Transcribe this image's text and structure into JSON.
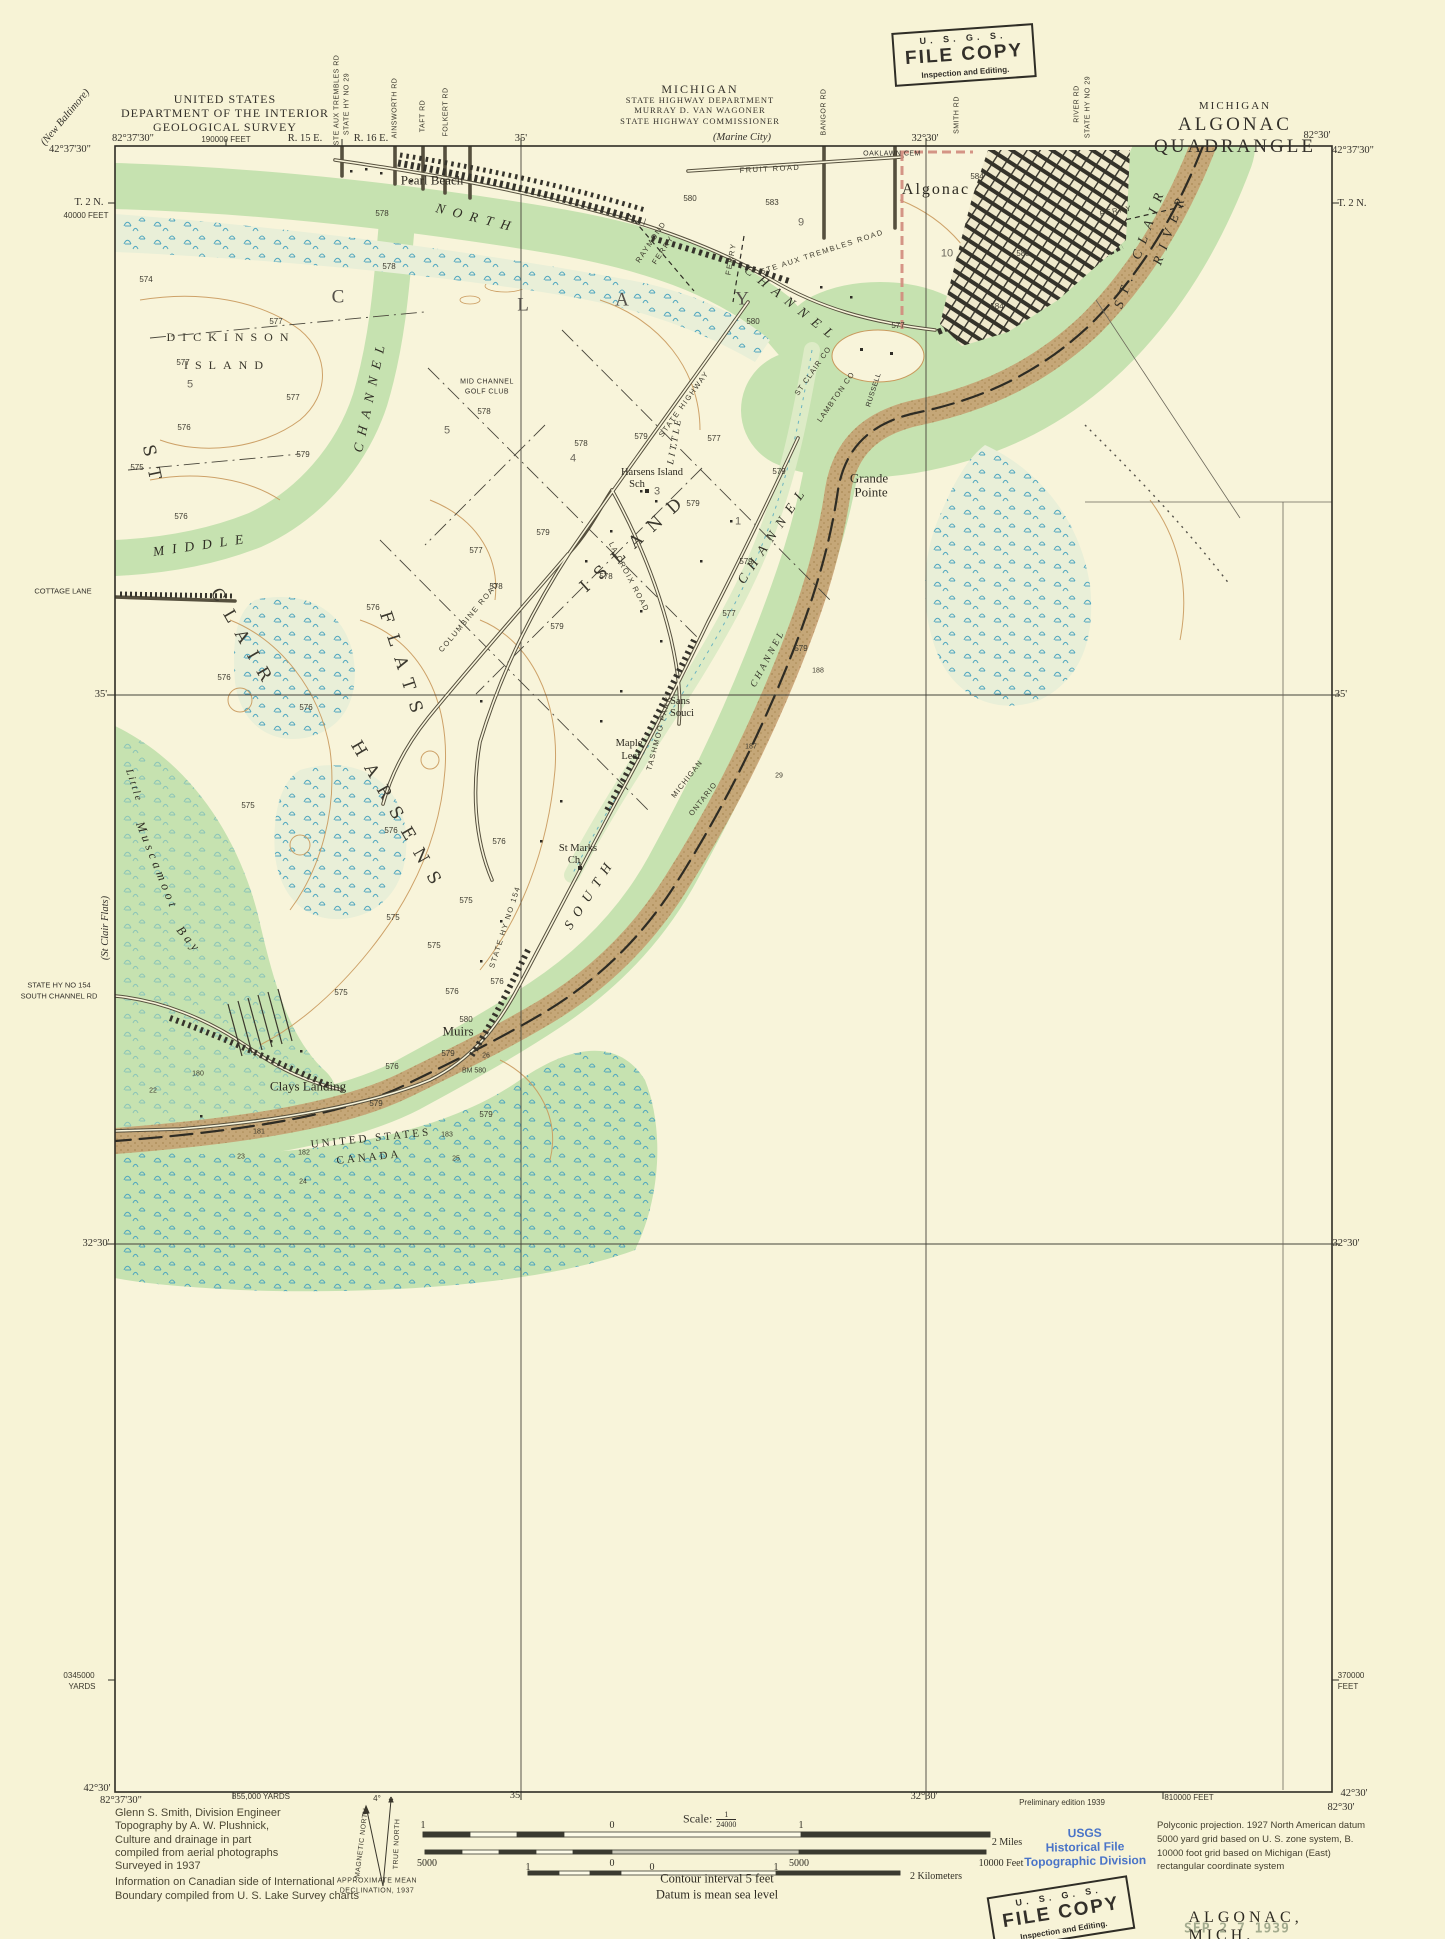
{
  "colors": {
    "paper": "#f7f3d6",
    "land": "#f8f4da",
    "water": "#c6e2b0",
    "marsh_base": "#e9efd8",
    "marsh_symbol": "#4fa6bf",
    "contour": "#c9995c",
    "urban": "#35332a",
    "channel_band": "#c59d6e",
    "boundary": "#2e2c24",
    "city_limit_pink": "#d18a7c",
    "stamp_blue": "#4a74c8",
    "date_stamp_green": "#a3ab8e"
  },
  "header": {
    "agency": [
      "UNITED STATES",
      "DEPARTMENT OF THE INTERIOR",
      "GEOLOGICAL SURVEY"
    ],
    "highway": [
      "MICHIGAN",
      "STATE HIGHWAY DEPARTMENT",
      "MURRAY D. VAN WAGONER",
      "STATE HIGHWAY COMMISSIONER"
    ],
    "quad_state": "MICHIGAN",
    "quad_name": "ALGONAC QUADRANGLE"
  },
  "stamps": {
    "top": {
      "line1": "U. S. G. S.",
      "line2": "FILE COPY",
      "line3": "Inspection and Editing."
    },
    "bottom": {
      "line1": "U. S. G. S.",
      "line2": "FILE COPY",
      "line3": "Inspection and Editing."
    },
    "blue": [
      "USGS",
      "Historical File",
      "Topographic Division"
    ],
    "date": "SEP 2 7 1939"
  },
  "footer": {
    "credits": [
      "Glenn S. Smith, Division Engineer",
      "Topography by A. W. Plushnick,",
      "Culture and drainage in part",
      "compiled from aerial photographs",
      "Surveyed in 1937",
      "Information on Canadian side of International",
      "Boundary compiled from U. S. Lake Survey charts"
    ],
    "scale_prefix": "Scale:",
    "scale_num": "1",
    "scale_den": "24000",
    "contour": "Contour interval 5 feet",
    "datum": "Datum is mean sea level",
    "projection": [
      "Polyconic projection.   1927 North American datum",
      "5000 yard grid based on U. S. zone system, B.",
      "10000 foot grid based on Michigan (East)",
      "rectangular coordinate system"
    ],
    "map_name": "ALGONAC, MICH."
  },
  "map_labels": [
    {
      "t": "Pearl Beach",
      "x": 432,
      "y": 180,
      "c": "place"
    },
    {
      "t": "Algonac",
      "x": 936,
      "y": 190,
      "c": "place-lg"
    },
    {
      "t": "NORTH",
      "x": 477,
      "y": 218,
      "r": 14,
      "c": "hydro"
    },
    {
      "t": "CHANNEL",
      "x": 792,
      "y": 304,
      "r": 38,
      "c": "hydro"
    },
    {
      "t": "ST",
      "x": 152,
      "y": 468,
      "r": 78,
      "c": "hydro-lg"
    },
    {
      "t": "CLAIR",
      "x": 243,
      "y": 640,
      "r": 60,
      "c": "hydro-lg"
    },
    {
      "t": "FLATS",
      "x": 402,
      "y": 668,
      "r": 72,
      "c": "hydro-lg"
    },
    {
      "t": "HARSENS",
      "x": 398,
      "y": 818,
      "r": 60,
      "c": "hydro-lg"
    },
    {
      "t": "ISLAND",
      "x": 636,
      "y": 542,
      "r": -42,
      "c": "hydro-lg"
    },
    {
      "t": "MIDDLE",
      "x": 202,
      "y": 545,
      "r": -8,
      "c": "hydro"
    },
    {
      "t": "CHANNEL",
      "x": 370,
      "y": 395,
      "r": -78,
      "c": "hydro"
    },
    {
      "t": "SOUTH",
      "x": 590,
      "y": 893,
      "r": -57,
      "c": "hydro"
    },
    {
      "t": "CHANNEL",
      "x": 773,
      "y": 534,
      "r": -56,
      "c": "hydro"
    },
    {
      "t": "LITTLE",
      "x": 676,
      "y": 441,
      "r": -80,
      "c": "hydro-sm"
    },
    {
      "t": "CHANNEL",
      "x": 769,
      "y": 659,
      "r": -62,
      "c": "hydro-sm"
    },
    {
      "t": "ST. CLAIR",
      "x": 1140,
      "y": 247,
      "r": -70,
      "c": "hydro"
    },
    {
      "t": "RIVER",
      "x": 1170,
      "y": 228,
      "r": -70,
      "c": "hydro"
    },
    {
      "t": "DICKINSON",
      "x": 231,
      "y": 337,
      "c": "area"
    },
    {
      "t": "ISLAND",
      "x": 227,
      "y": 365,
      "c": "area"
    },
    {
      "t": "C",
      "x": 338,
      "y": 297,
      "c": "area-lg"
    },
    {
      "t": "L",
      "x": 523,
      "y": 305,
      "c": "area-lg"
    },
    {
      "t": "A",
      "x": 622,
      "y": 300,
      "c": "area-lg"
    },
    {
      "t": "Y",
      "x": 742,
      "y": 299,
      "c": "area-lg"
    },
    {
      "t": "Little",
      "x": 133,
      "y": 786,
      "r": 72,
      "c": "bay-sm"
    },
    {
      "t": "Muscamoot",
      "x": 157,
      "y": 866,
      "r": 68,
      "c": "bay"
    },
    {
      "t": "Bay",
      "x": 189,
      "y": 940,
      "r": 50,
      "c": "bay"
    },
    {
      "t": "Grande",
      "x": 869,
      "y": 478,
      "c": "place"
    },
    {
      "t": "Pointe",
      "x": 871,
      "y": 492,
      "c": "place"
    },
    {
      "t": "Sans",
      "x": 680,
      "y": 702,
      "c": "place-sm"
    },
    {
      "t": "Souci",
      "x": 682,
      "y": 714,
      "c": "place-sm"
    },
    {
      "t": "Maple",
      "x": 629,
      "y": 744,
      "c": "place-sm"
    },
    {
      "t": "Leaf",
      "x": 631,
      "y": 757,
      "c": "place-sm"
    },
    {
      "t": "St Marks",
      "x": 578,
      "y": 849,
      "c": "place-sm"
    },
    {
      "t": "Ch",
      "x": 574,
      "y": 861,
      "c": "place-sm"
    },
    {
      "t": "Muirs",
      "x": 458,
      "y": 1031,
      "c": "place"
    },
    {
      "t": "Clays Landing",
      "x": 308,
      "y": 1086,
      "c": "place"
    },
    {
      "t": "Harsens Island",
      "x": 652,
      "y": 473,
      "c": "place-sm"
    },
    {
      "t": "Sch",
      "x": 637,
      "y": 485,
      "c": "place-sm"
    },
    {
      "t": "MID CHANNEL",
      "x": 487,
      "y": 382,
      "c": "tiny"
    },
    {
      "t": "GOLF CLUB",
      "x": 487,
      "y": 392,
      "c": "tiny"
    },
    {
      "t": "RUSSELL",
      "x": 874,
      "y": 390,
      "r": -72,
      "c": "tiny"
    },
    {
      "t": "OAKLAWN CEM",
      "x": 892,
      "y": 154,
      "c": "tiny"
    },
    {
      "t": "FRUIT ROAD",
      "x": 770,
      "y": 169,
      "r": -3,
      "c": "road"
    },
    {
      "t": "STE AUX TREMBLES ROAD",
      "x": 822,
      "y": 252,
      "r": -18,
      "c": "road"
    },
    {
      "t": "STATE HIGHWAY",
      "x": 684,
      "y": 404,
      "r": -54,
      "c": "road"
    },
    {
      "t": "COLUMBINE ROAD",
      "x": 469,
      "y": 617,
      "r": -50,
      "c": "road"
    },
    {
      "t": "LA CROIX ROAD",
      "x": 629,
      "y": 577,
      "r": 62,
      "c": "road"
    },
    {
      "t": "TASHMOO PARK",
      "x": 659,
      "y": 733,
      "r": -75,
      "c": "road"
    },
    {
      "t": "STATE HY NO 154",
      "x": 505,
      "y": 927,
      "r": -72,
      "c": "road"
    },
    {
      "t": "RAYMOND",
      "x": 651,
      "y": 242,
      "r": -56,
      "c": "road"
    },
    {
      "t": "FERRY",
      "x": 663,
      "y": 250,
      "r": -56,
      "c": "road"
    },
    {
      "t": "FERRY",
      "x": 1116,
      "y": 211,
      "r": -10,
      "c": "road"
    },
    {
      "t": "FERRY",
      "x": 731,
      "y": 259,
      "r": -80,
      "c": "road"
    },
    {
      "t": "UNITED STATES",
      "x": 371,
      "y": 1139,
      "r": -6,
      "c": "bdy"
    },
    {
      "t": "CANADA",
      "x": 369,
      "y": 1158,
      "r": -6,
      "c": "bdy"
    },
    {
      "t": "MICHIGAN",
      "x": 687,
      "y": 779,
      "r": -52,
      "c": "bdy-sm"
    },
    {
      "t": "ONTARIO",
      "x": 703,
      "y": 799,
      "r": -52,
      "c": "bdy-sm"
    },
    {
      "t": "ST CLAIR CO",
      "x": 813,
      "y": 371,
      "r": -55,
      "c": "bdy-sm"
    },
    {
      "t": "LAMBTON CO",
      "x": 836,
      "y": 397,
      "r": -55,
      "c": "bdy-sm"
    }
  ],
  "numbers": [
    {
      "t": "574",
      "x": 146,
      "y": 280
    },
    {
      "t": "577",
      "x": 276,
      "y": 322
    },
    {
      "t": "577",
      "x": 183,
      "y": 363
    },
    {
      "t": "577",
      "x": 293,
      "y": 398
    },
    {
      "t": "576",
      "x": 184,
      "y": 428
    },
    {
      "t": "579",
      "x": 303,
      "y": 455
    },
    {
      "t": "575",
      "x": 137,
      "y": 468
    },
    {
      "t": "576",
      "x": 181,
      "y": 517
    },
    {
      "t": "578",
      "x": 382,
      "y": 214
    },
    {
      "t": "578",
      "x": 389,
      "y": 267
    },
    {
      "t": "576",
      "x": 373,
      "y": 608
    },
    {
      "t": "576",
      "x": 224,
      "y": 678
    },
    {
      "t": "576",
      "x": 306,
      "y": 708
    },
    {
      "t": "575",
      "x": 248,
      "y": 806
    },
    {
      "t": "576",
      "x": 391,
      "y": 831
    },
    {
      "t": "576",
      "x": 499,
      "y": 842
    },
    {
      "t": "575",
      "x": 466,
      "y": 901
    },
    {
      "t": "575",
      "x": 393,
      "y": 918
    },
    {
      "t": "575",
      "x": 434,
      "y": 946
    },
    {
      "t": "576",
      "x": 497,
      "y": 982
    },
    {
      "t": "576",
      "x": 452,
      "y": 992
    },
    {
      "t": "575",
      "x": 341,
      "y": 993
    },
    {
      "t": "576",
      "x": 392,
      "y": 1067
    },
    {
      "t": "580",
      "x": 466,
      "y": 1020
    },
    {
      "t": "579",
      "x": 448,
      "y": 1054
    },
    {
      "t": "579",
      "x": 486,
      "y": 1115
    },
    {
      "t": "579",
      "x": 376,
      "y": 1104
    },
    {
      "t": "578",
      "x": 581,
      "y": 444
    },
    {
      "t": "578",
      "x": 484,
      "y": 412
    },
    {
      "t": "579",
      "x": 641,
      "y": 437
    },
    {
      "t": "577",
      "x": 714,
      "y": 439
    },
    {
      "t": "579",
      "x": 779,
      "y": 472
    },
    {
      "t": "579",
      "x": 693,
      "y": 504
    },
    {
      "t": "577",
      "x": 476,
      "y": 551
    },
    {
      "t": "579",
      "x": 543,
      "y": 533
    },
    {
      "t": "578",
      "x": 496,
      "y": 587
    },
    {
      "t": "579",
      "x": 557,
      "y": 627
    },
    {
      "t": "577",
      "x": 729,
      "y": 614
    },
    {
      "t": "579",
      "x": 746,
      "y": 562
    },
    {
      "t": "579",
      "x": 801,
      "y": 649
    },
    {
      "t": "578",
      "x": 606,
      "y": 577
    },
    {
      "t": "583",
      "x": 772,
      "y": 203
    },
    {
      "t": "584",
      "x": 977,
      "y": 177
    },
    {
      "t": "580",
      "x": 1023,
      "y": 254
    },
    {
      "t": "584",
      "x": 997,
      "y": 307
    },
    {
      "t": "580",
      "x": 690,
      "y": 199
    },
    {
      "t": "577",
      "x": 898,
      "y": 326
    },
    {
      "t": "580",
      "x": 753,
      "y": 322
    },
    {
      "t": "9",
      "x": 801,
      "y": 223,
      "c": "section"
    },
    {
      "t": "10",
      "x": 947,
      "y": 254,
      "c": "section"
    },
    {
      "t": "5",
      "x": 190,
      "y": 385,
      "c": "section"
    },
    {
      "t": "5",
      "x": 447,
      "y": 431,
      "c": "section"
    },
    {
      "t": "4",
      "x": 573,
      "y": 459,
      "c": "section"
    },
    {
      "t": "3",
      "x": 657,
      "y": 492,
      "c": "section"
    },
    {
      "t": "1",
      "x": 738,
      "y": 522,
      "c": "section"
    },
    {
      "t": "188",
      "x": 818,
      "y": 671,
      "c": "mon"
    },
    {
      "t": "187",
      "x": 751,
      "y": 747,
      "c": "mon"
    },
    {
      "t": "183",
      "x": 447,
      "y": 1135,
      "c": "mon"
    },
    {
      "t": "182",
      "x": 304,
      "y": 1153,
      "c": "mon"
    },
    {
      "t": "181",
      "x": 259,
      "y": 1132,
      "c": "mon"
    },
    {
      "t": "180",
      "x": 198,
      "y": 1074,
      "c": "mon"
    },
    {
      "t": "29",
      "x": 779,
      "y": 776,
      "c": "mon"
    },
    {
      "t": "26",
      "x": 486,
      "y": 1056,
      "c": "mon"
    },
    {
      "t": "25",
      "x": 456,
      "y": 1159,
      "c": "mon"
    },
    {
      "t": "24",
      "x": 303,
      "y": 1182,
      "c": "mon"
    },
    {
      "t": "23",
      "x": 241,
      "y": 1157,
      "c": "mon"
    },
    {
      "t": "22",
      "x": 153,
      "y": 1091,
      "c": "mon"
    },
    {
      "t": "BM 580",
      "x": 474,
      "y": 1071,
      "c": "mon"
    }
  ],
  "annotations": [
    {
      "t": "82°37'30\"",
      "x": 133,
      "y": 139
    },
    {
      "t": "190000 FEET",
      "x": 226,
      "y": 140,
      "c": "coord-sm"
    },
    {
      "t": "R. 15 E.",
      "x": 305,
      "y": 139
    },
    {
      "t": "R. 16 E.",
      "x": 371,
      "y": 139
    },
    {
      "t": "35'",
      "x": 521,
      "y": 139
    },
    {
      "t": "(Marine City)",
      "x": 742,
      "y": 138,
      "c": "dest"
    },
    {
      "t": "32°30'",
      "x": 925,
      "y": 139
    },
    {
      "t": "82°30'",
      "x": 1317,
      "y": 136
    },
    {
      "t": "42°37'30\"",
      "x": 1353,
      "y": 151
    },
    {
      "t": "STE AUX TREMBLES RD",
      "x": 337,
      "y": 100,
      "r": -90,
      "c": "vroad"
    },
    {
      "t": "STATE HY NO 29",
      "x": 347,
      "y": 104,
      "r": -90,
      "c": "vroad"
    },
    {
      "t": "AINSWORTH RD",
      "x": 395,
      "y": 108,
      "r": -90,
      "c": "vroad"
    },
    {
      "t": "TAFT RD",
      "x": 423,
      "y": 116,
      "r": -90,
      "c": "vroad"
    },
    {
      "t": "FOLKERT RD",
      "x": 446,
      "y": 112,
      "r": -90,
      "c": "vroad"
    },
    {
      "t": "BANGOR RD",
      "x": 824,
      "y": 112,
      "r": -90,
      "c": "vroad"
    },
    {
      "t": "SMITH RD",
      "x": 957,
      "y": 115,
      "r": -90,
      "c": "vroad"
    },
    {
      "t": "RIVER RD",
      "x": 1077,
      "y": 104,
      "r": -90,
      "c": "vroad"
    },
    {
      "t": "STATE HY NO 29",
      "x": 1088,
      "y": 107,
      "r": -90,
      "c": "vroad"
    },
    {
      "t": "(New Baltimore)",
      "x": 66,
      "y": 118,
      "r": -50,
      "c": "dest"
    },
    {
      "t": "42°37'30\"",
      "x": 70,
      "y": 150
    },
    {
      "t": "T. 2 N.",
      "x": 89,
      "y": 203
    },
    {
      "t": "40000 FEET",
      "x": 86,
      "y": 216,
      "c": "coord-sm"
    },
    {
      "t": "COTTAGE LANE",
      "x": 63,
      "y": 591,
      "c": "edge-sm"
    },
    {
      "t": "35'",
      "x": 101,
      "y": 695
    },
    {
      "t": "(St Clair Flats)",
      "x": 106,
      "y": 928,
      "r": -90,
      "c": "dest"
    },
    {
      "t": "STATE HY NO 154",
      "x": 59,
      "y": 985,
      "c": "edge-sm"
    },
    {
      "t": "SOUTH CHANNEL RD",
      "x": 59,
      "y": 996,
      "c": "edge-sm"
    },
    {
      "t": "32°30'",
      "x": 96,
      "y": 1244
    },
    {
      "t": "0345000",
      "x": 79,
      "y": 1676,
      "c": "coord-sm"
    },
    {
      "t": "YARDS",
      "x": 82,
      "y": 1687,
      "c": "coord-sm"
    },
    {
      "t": "42°30'",
      "x": 97,
      "y": 1789
    },
    {
      "t": "82°37'30\"",
      "x": 121,
      "y": 1801
    },
    {
      "t": "T. 2 N.",
      "x": 1352,
      "y": 204
    },
    {
      "t": "35'",
      "x": 1341,
      "y": 695
    },
    {
      "t": "32°30'",
      "x": 1346,
      "y": 1244
    },
    {
      "t": "370000",
      "x": 1351,
      "y": 1676,
      "c": "coord-sm"
    },
    {
      "t": "FEET",
      "x": 1348,
      "y": 1687,
      "c": "coord-sm"
    },
    {
      "t": "42°30'",
      "x": 1354,
      "y": 1794
    },
    {
      "t": "82°30'",
      "x": 1341,
      "y": 1808
    },
    {
      "t": "855,000 YARDS",
      "x": 261,
      "y": 1797,
      "c": "coord-sm"
    },
    {
      "t": "35'",
      "x": 516,
      "y": 1796
    },
    {
      "t": "32°30'",
      "x": 924,
      "y": 1797
    },
    {
      "t": "Preliminary edition 1939",
      "x": 1062,
      "y": 1803,
      "c": "coord-sm"
    },
    {
      "t": "810000 FEET",
      "x": 1189,
      "y": 1798,
      "c": "coord-sm"
    },
    {
      "t": "4°",
      "x": 377,
      "y": 1799,
      "c": "coord-sm"
    },
    {
      "t": "MAGNETIC NORTH",
      "x": 362,
      "y": 1843,
      "r": -83,
      "c": "decl"
    },
    {
      "t": "TRUE NORTH",
      "x": 397,
      "y": 1844,
      "r": -88,
      "c": "decl"
    },
    {
      "t": "APPROXIMATE MEAN",
      "x": 377,
      "y": 1881,
      "c": "decl"
    },
    {
      "t": "DECLINATION, 1937",
      "x": 377,
      "y": 1891,
      "c": "decl"
    },
    {
      "t": "1",
      "x": 423,
      "y": 1826,
      "c": "bar"
    },
    {
      "t": "0",
      "x": 612,
      "y": 1826,
      "c": "bar"
    },
    {
      "t": "1",
      "x": 801,
      "y": 1826,
      "c": "bar"
    },
    {
      "t": "2 Miles",
      "x": 1007,
      "y": 1843,
      "c": "bar"
    },
    {
      "t": "5000",
      "x": 427,
      "y": 1864,
      "c": "bar"
    },
    {
      "t": "0",
      "x": 612,
      "y": 1864,
      "c": "bar"
    },
    {
      "t": "5000",
      "x": 799,
      "y": 1864,
      "c": "bar"
    },
    {
      "t": "10000 Feet",
      "x": 1001,
      "y": 1864,
      "c": "bar"
    },
    {
      "t": "1",
      "x": 528,
      "y": 1868,
      "c": "bar"
    },
    {
      "t": "0",
      "x": 652,
      "y": 1868,
      "c": "bar"
    },
    {
      "t": "1",
      "x": 776,
      "y": 1868,
      "c": "bar"
    },
    {
      "t": "2 Kilometers",
      "x": 936,
      "y": 1877,
      "c": "bar"
    }
  ]
}
